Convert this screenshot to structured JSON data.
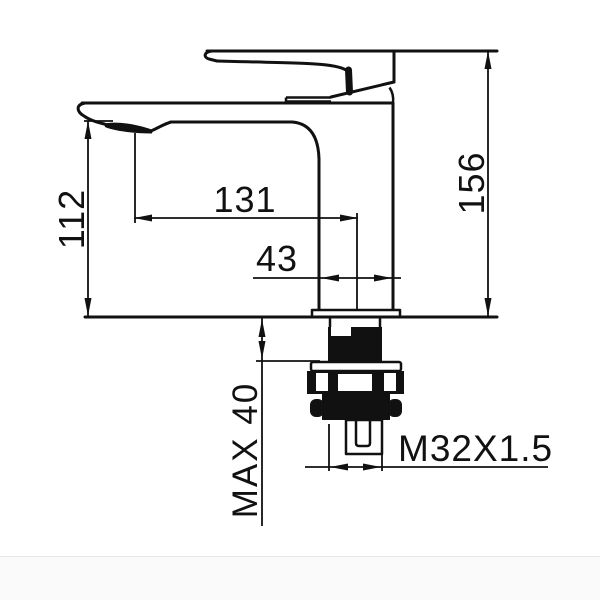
{
  "drawing": {
    "background": "#ffffff",
    "line_color": "#111111",
    "labels": {
      "dim_spout_height": "112",
      "dim_spout_reach": "131",
      "dim_body_depth": "43",
      "dim_overall_height": "156",
      "dim_max_deck": "MAX 40",
      "thread_spec": "M32X1.5"
    }
  }
}
